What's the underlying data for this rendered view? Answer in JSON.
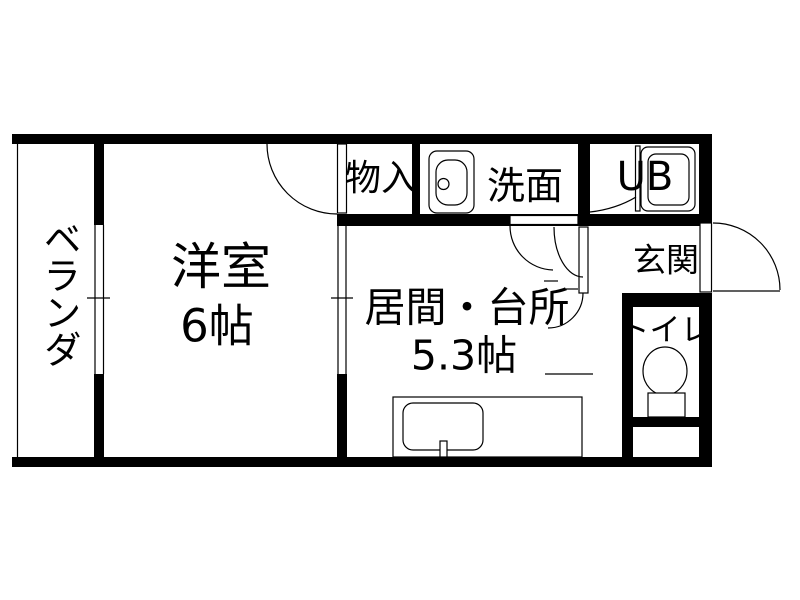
{
  "floorplan": {
    "type": "japanese-apartment-floorplan",
    "rooms": [
      {
        "id": "veranda",
        "label": "ベランダ"
      },
      {
        "id": "western-room",
        "label": "洋室",
        "size_label": "6帖"
      },
      {
        "id": "storage",
        "label": "物入"
      },
      {
        "id": "washroom",
        "label": "洗面"
      },
      {
        "id": "unit-bath",
        "label": "UB"
      },
      {
        "id": "entrance",
        "label": "玄関"
      },
      {
        "id": "living-kitchen",
        "label": "居間・台所",
        "size_label": "5.3帖"
      },
      {
        "id": "toilet",
        "label": "トイレ"
      }
    ],
    "fixtures": [
      {
        "id": "wash-basin",
        "name": "washroom sink icon"
      },
      {
        "id": "bathtub",
        "name": "unit bath tub icon"
      },
      {
        "id": "kitchen-sink",
        "name": "kitchen counter with sink and faucet"
      },
      {
        "id": "toilet-bowl",
        "name": "toilet bowl with tank icon"
      }
    ],
    "colors": {
      "wall": "#000000",
      "background": "#ffffff",
      "line": "#000000"
    }
  }
}
